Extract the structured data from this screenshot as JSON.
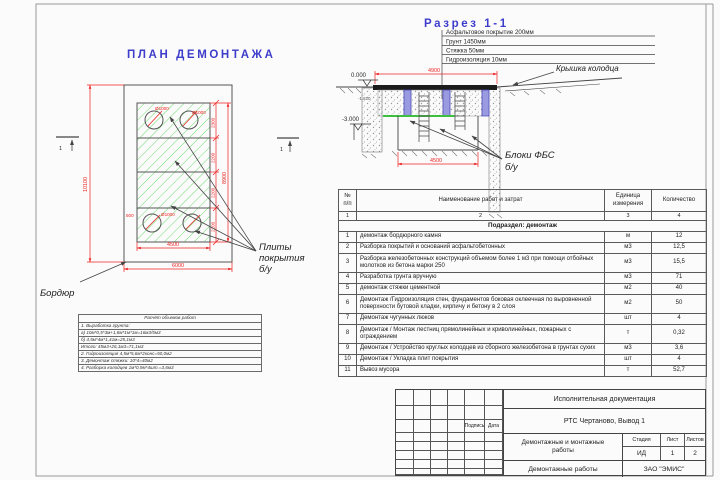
{
  "colors": {
    "title_blue": "#3d3dcb",
    "dimension_red": "#ee2222",
    "hatch_green": "#5fd75f"
  },
  "plan": {
    "title": "ПЛАН ДЕМОНТАЖА",
    "labels": {
      "curb": "Бордюр",
      "slabs_line1": "Плиты",
      "slabs_line2": "покрытия",
      "slabs_line3": "б/у",
      "section_mark": "1"
    },
    "dims": {
      "total_height": "10100",
      "total_width": "6000",
      "inner_width": "4500",
      "inner_height": "8900",
      "segments": [
        "2300",
        "2200",
        "2200",
        "2200"
      ],
      "offset": "500",
      "hole_dia_top1": "Ø1000",
      "hole_dia_top2": "Ø1000",
      "hole_dia_bottom": "Ø1000"
    }
  },
  "section": {
    "title": "Разрез 1-1",
    "layers": [
      "Асфальтовое покрытие 200мм",
      "Грунт 1450мм",
      "Стяжка 50мм",
      "Гидроизоляция 10мм"
    ],
    "labels": {
      "cover": "Крышка колодца",
      "blocks_line1": "Блоки ФБС",
      "blocks_line2": "б/у"
    },
    "elevations": {
      "zero": "0.000",
      "mid": "-1.810",
      "bottom": "-3.000"
    },
    "dims": {
      "top_width": "4900",
      "bottom_width": "4500"
    }
  },
  "works_table": {
    "headers": {
      "num": "№ п/п",
      "name": "Наименование работ и затрат",
      "unit": "Единица измерения",
      "qty": "Количество"
    },
    "col_nums": [
      "1",
      "2",
      "3",
      "4"
    ],
    "subsection": "Подраздел: демонтаж",
    "rows": [
      {
        "num": "1",
        "name": "демонтаж бордюрного камня",
        "unit": "м",
        "qty": "12"
      },
      {
        "num": "2",
        "name": "Разборка покрытий и оснований асфальтобетонных",
        "unit": "м3",
        "qty": "12,5"
      },
      {
        "num": "3",
        "name": "Разборка железобетонных конструкций объемом более 1 м3 при помощи отбойных молотков из бетона марки 250",
        "unit": "м3",
        "qty": "15,5"
      },
      {
        "num": "4",
        "name": "Разработка грунта вручную",
        "unit": "м3",
        "qty": "71"
      },
      {
        "num": "5",
        "name": "демонтаж стяжки цементной",
        "unit": "м2",
        "qty": "40"
      },
      {
        "num": "6",
        "name": "Демонтаж /Гидроизоляция стен, фундаментов боковая оклеечная по выровненной поверхности бутовой кладки, кирпичу и бетону в 2 слоя",
        "unit": "м2",
        "qty": "50"
      },
      {
        "num": "7",
        "name": "Демонтаж чугунных люков",
        "unit": "шт",
        "qty": "4"
      },
      {
        "num": "8",
        "name": "Демонтаж / Монтаж лестниц прямолинейных и криволинейных, пожарных с ограждением",
        "unit": "т",
        "qty": "0,32"
      },
      {
        "num": "9",
        "name": "Демонтаж / Устройство круглых колодцев из сборного железобетона в грунтах сухих",
        "unit": "м3",
        "qty": "3,6"
      },
      {
        "num": "10",
        "name": "Демонтаж / Укладка плит покрытия",
        "unit": "шт",
        "qty": "4"
      },
      {
        "num": "11",
        "name": "Вывоз мусора",
        "unit": "т",
        "qty": "52,7"
      }
    ]
  },
  "calc_table": {
    "title": "Расчёт объемов работ",
    "lines": [
      "1. Выработка грунта:",
      "а) 10м*0,5*3м+1,8м*1м*1м=16м3/5м3",
      "б) 4,5м*4м*1,41м=25,1м3",
      "Итого: 45м3+26,1м3=71,1м3",
      "2. Гидроизоляция 4,5м*5,6м*2конс=50,0м2",
      "3. Демонтаж стяжки: 10*4=40м2",
      "4. Разборка колодцев 1м*0,9м*4шт.=3,6м3"
    ]
  },
  "title_block": {
    "doc_type": "Исполнительная документация",
    "object": "РТС Чертаново, Вывод 1",
    "work_name": "Демонтажные и монтажные работы",
    "sheet_name": "Демонтажные работы",
    "company": "ЗАО \"ЭМИС\"",
    "stage_label": "Стадия",
    "sheet_label": "Лист",
    "sheets_label": "Листов",
    "stage": "ИД",
    "sheet": "1",
    "sheets": "2",
    "sign_label": "Подпись",
    "date_label": "Дата"
  }
}
